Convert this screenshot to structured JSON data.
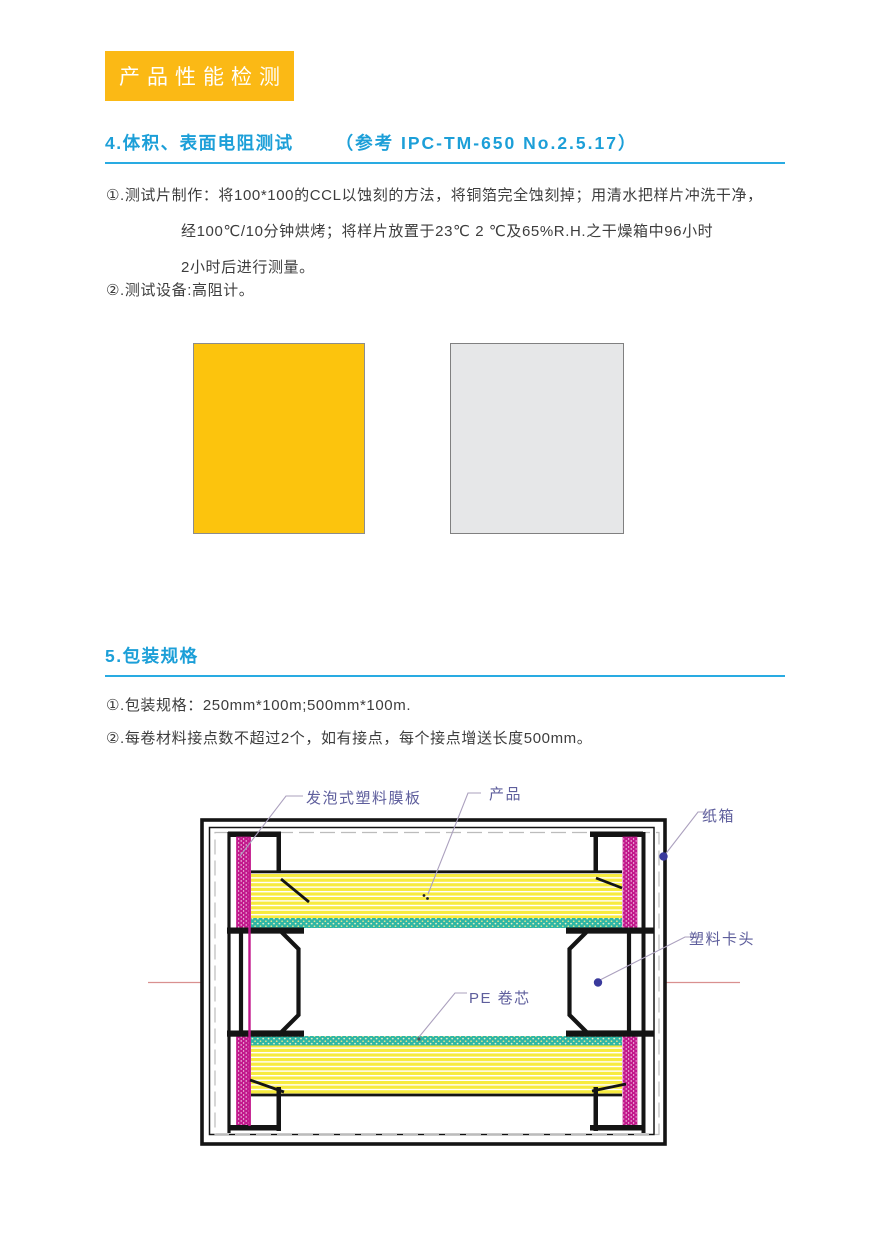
{
  "badge": {
    "label": "产品性能检测"
  },
  "section4": {
    "title": "4.体积、表面电阻测试",
    "reference": "（参考 IPC-TM-650 No.2.5.17）",
    "item1_line1": "①.测试片制作：将100*100的CCL以蚀刻的方法，将铜箔完全蚀刻掉；用清水把样片冲洗干净，",
    "item1_line2": "经100℃/10分钟烘烤；将样片放置于23℃ 2 ℃及65%R.H.之干燥箱中96小时",
    "item1_line3": "2小时后进行测量。",
    "item2": "②.测试设备:高阻计。"
  },
  "samples": {
    "yellow_swatch_color": "#FCC40D",
    "gray_swatch_color": "#E6E7E8"
  },
  "section5": {
    "title": "5.包装规格",
    "item1": "①.包装规格：250mm*100m;500mm*100m.",
    "item2": "②.每卷材料接点数不超过2个，如有接点，每个接点增送长度500mm。"
  },
  "diagram": {
    "labels": {
      "foam_board": "发泡式塑料膜板",
      "product": "产品",
      "carton": "纸箱",
      "plastic_clip": "塑料卡头",
      "pe_core": "PE 卷芯"
    },
    "colors": {
      "roll_yellow": "#F7EB3E",
      "foam_magenta": "#C2188C",
      "core_teal": "#2EB6A5",
      "centerline_pink": "#D9908F",
      "marker_blue": "#3A3A9C",
      "label_text": "#5E5E9C",
      "outline_black": "#141414"
    }
  },
  "theme": {
    "accent_cyan": "#29ABE2",
    "heading_text": "#1C9FD8",
    "badge_bg": "#FBB915",
    "body_text": "#3d3d3d"
  }
}
